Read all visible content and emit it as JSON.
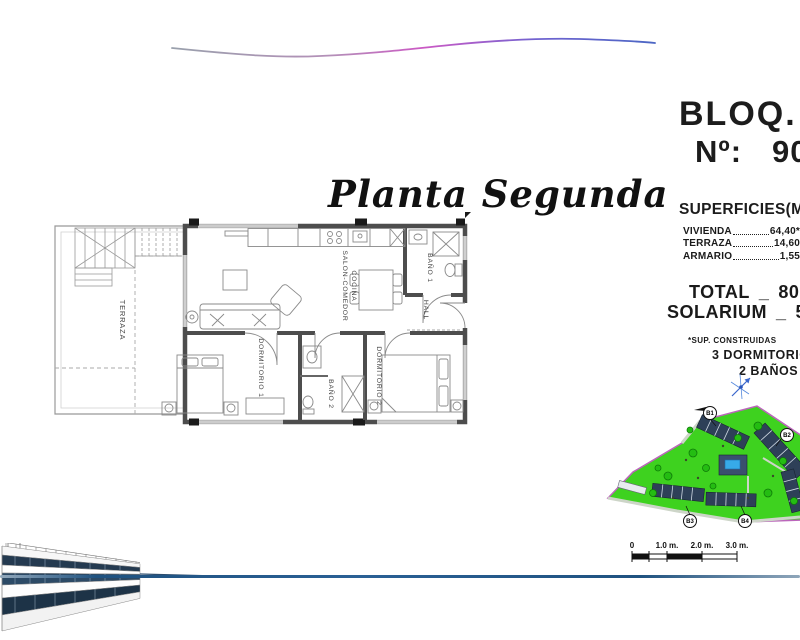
{
  "header": {
    "block_title": "BLOQ. 5",
    "unit_label": "Nº:",
    "unit_number": "90"
  },
  "plan_title": "Planta Segunda",
  "superficies": {
    "title": "SUPERFICIES(M2)",
    "rows": [
      {
        "label": "VIVIENDA",
        "value": "64,40*"
      },
      {
        "label": "TERRAZA",
        "value": "14,60"
      },
      {
        "label": "ARMARIO",
        "value": "1,55"
      }
    ],
    "total": {
      "label": "TOTAL",
      "sep": "_",
      "value": "80,55"
    },
    "solarium": {
      "label": "SOLARIUM",
      "sep": "_",
      "value": "59,50"
    },
    "footnote": "*SUP. CONSTRUIDAS",
    "features": [
      "3 DORMITORIOS",
      "2 BAÑOS"
    ]
  },
  "floor_plan": {
    "rooms": {
      "terraza": "TERRAZA",
      "salon": "SALON-COMEDOR",
      "cocina": "COCINA",
      "bano1": "BAÑO 1",
      "hall": "HALL",
      "dormitorio1": "DORMITORIO 1",
      "bano2": "BAÑO 2",
      "dormitorio2": "DORMITORIO 2"
    }
  },
  "site_plan": {
    "block_labels": [
      "B1",
      "B2",
      "B3",
      "B4"
    ]
  },
  "scale_bar": {
    "ticks": [
      "0",
      "1.0 m.",
      "2.0 m.",
      "3.0 m."
    ]
  },
  "colors": {
    "wave_gray": "#99a0ac",
    "wave_magenta": "#cb59c4",
    "wave_blue": "#4b66c4",
    "footer_line_blue": "#1f5280",
    "site_green": "#3ed21f",
    "site_border_pink": "#bb66bb",
    "building_navy": "#2e4058",
    "pool_blue": "#37aae8",
    "wall_gray": "#4d4d4d"
  }
}
